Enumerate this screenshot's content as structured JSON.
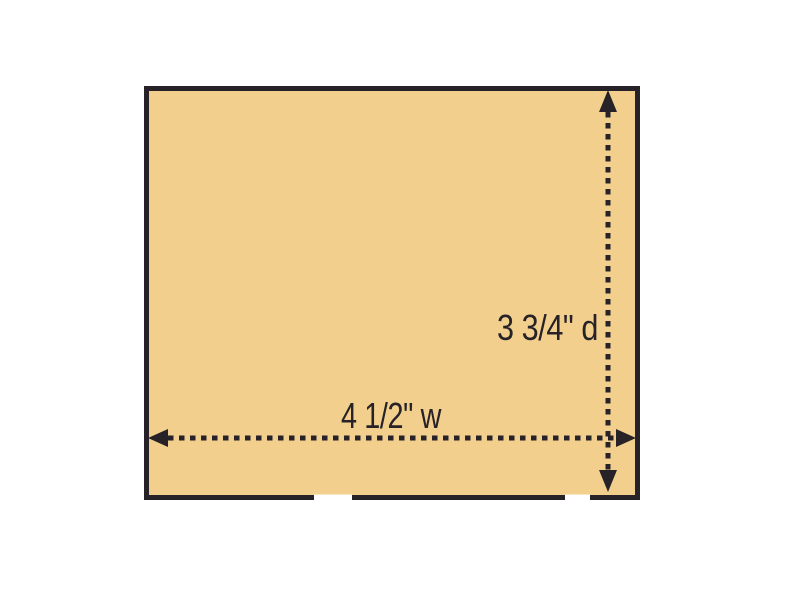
{
  "colors": {
    "background": "#FFFFFF",
    "board_fill": "#F2CF8C",
    "ink": "#262228"
  },
  "diagram": {
    "depth_label": "3 3/4\" d",
    "width_label": "4 1/2\" w"
  }
}
